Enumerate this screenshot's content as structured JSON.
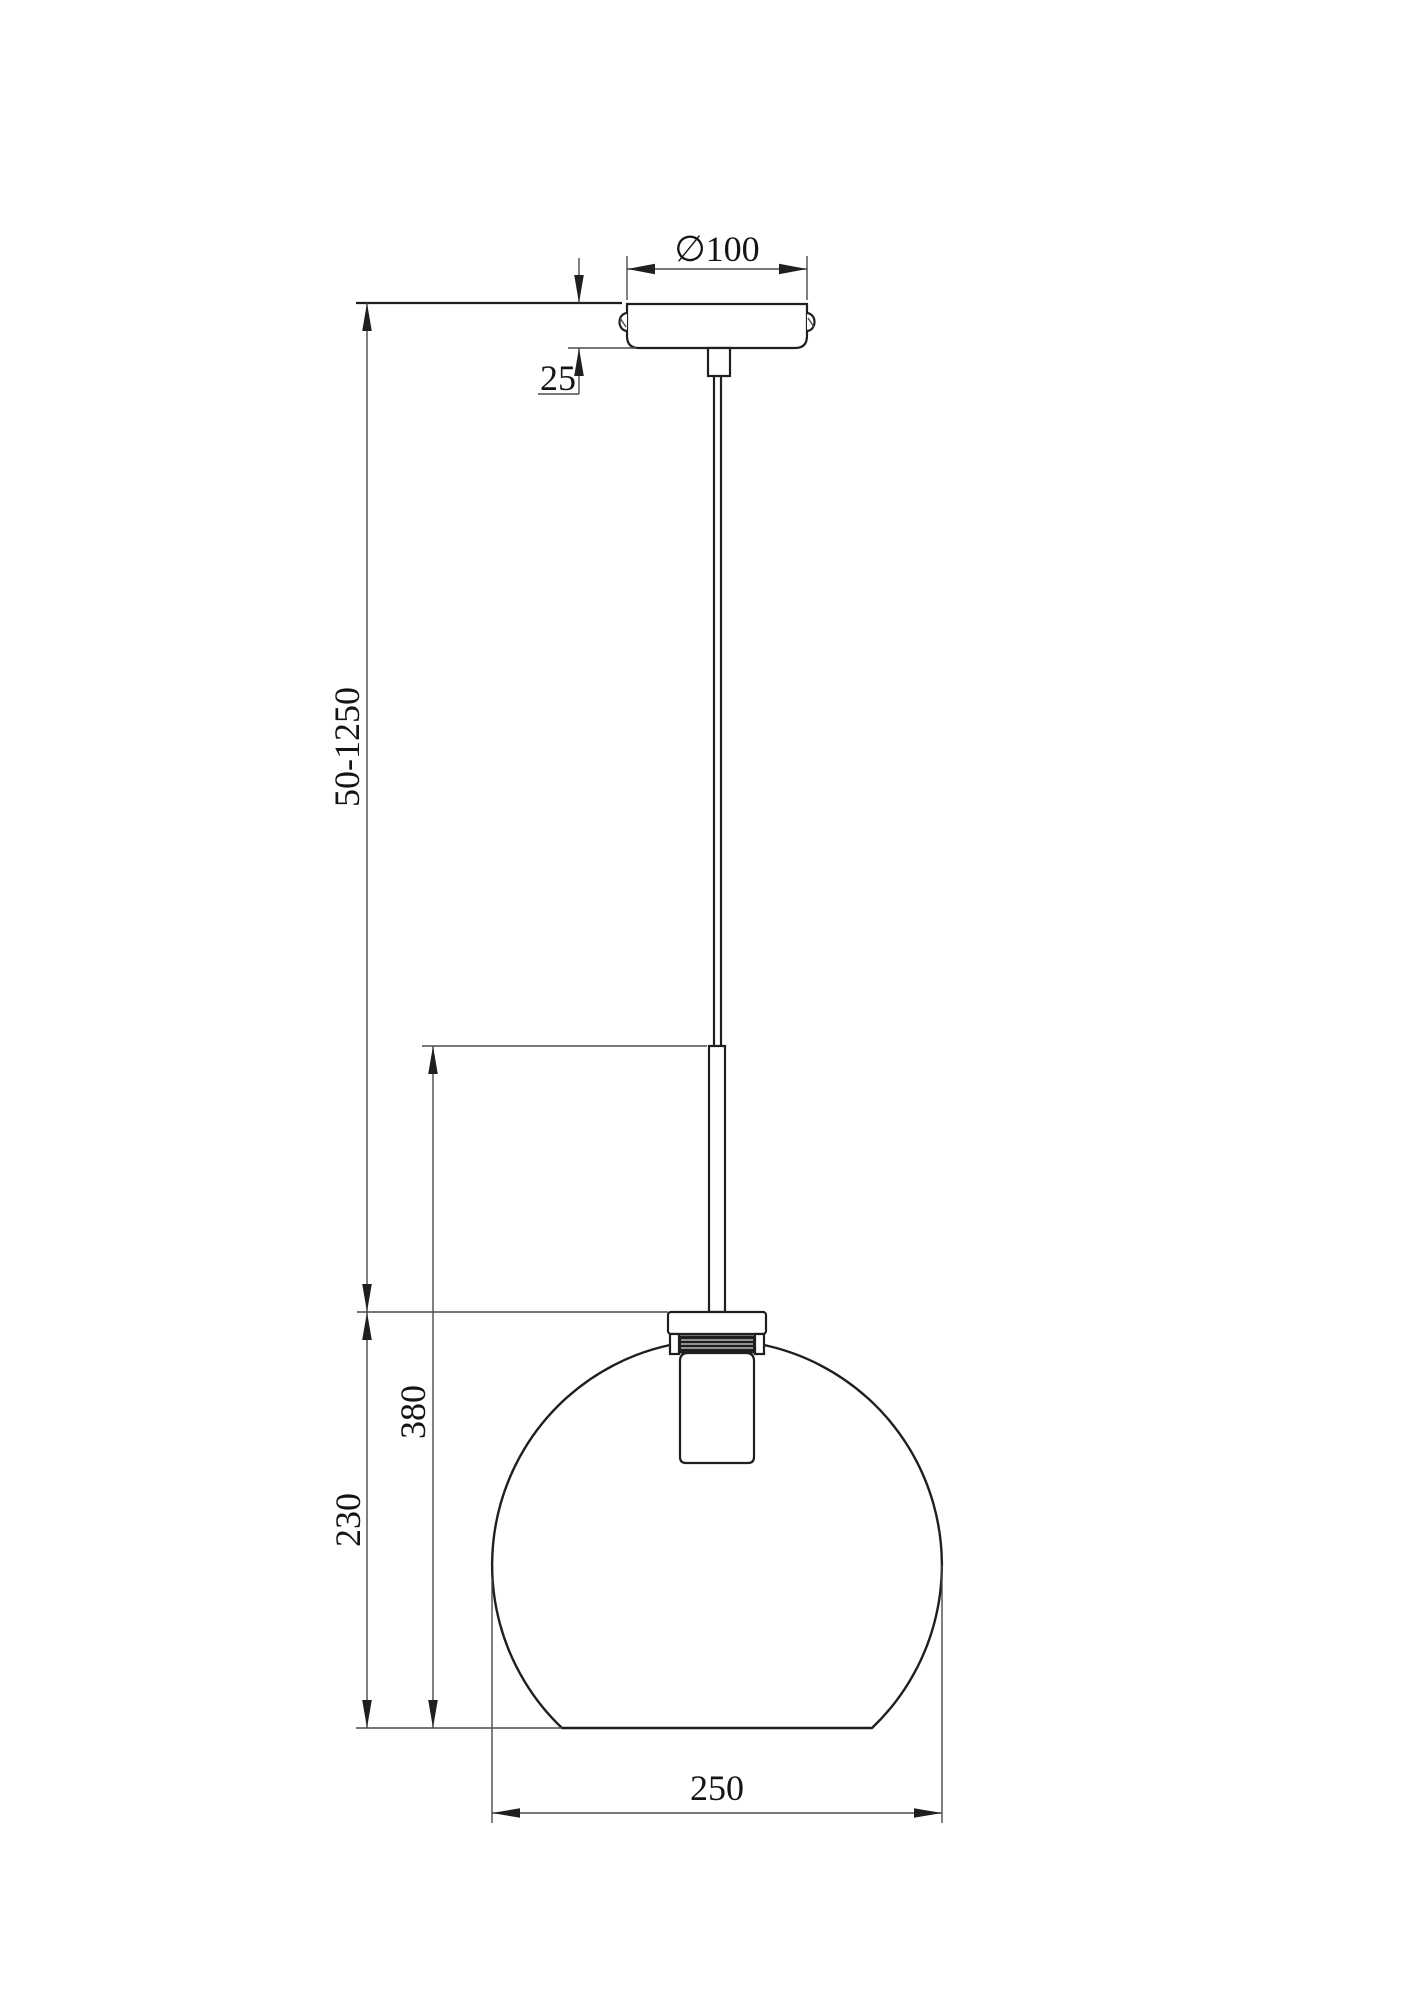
{
  "drawing": {
    "type": "technical-dimension-drawing",
    "subject": "pendant-lamp-with-spherical-glass-shade",
    "colors": {
      "background": "#ffffff",
      "object_line": "#1f1f1f",
      "dimension_line": "#4a4a4a",
      "text": "#141414"
    },
    "labels": {
      "canopy_diameter": "∅100",
      "canopy_height": "25",
      "suspension_length": "50-1250",
      "fixture_height": "380",
      "shade_height": "230",
      "shade_diameter": "250"
    }
  }
}
